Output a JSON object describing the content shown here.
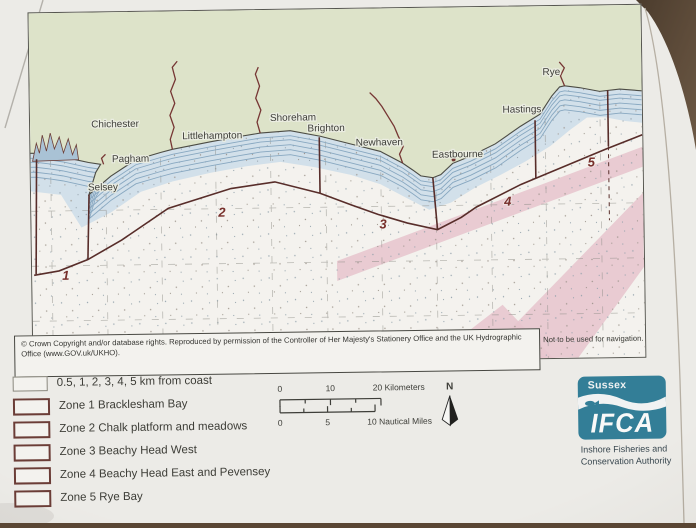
{
  "map": {
    "towns": [
      "Chichester",
      "Pagham",
      "Selsey",
      "Littlehampton",
      "Shoreham",
      "Brighton",
      "Newhaven",
      "Eastbourne",
      "Hastings",
      "Rye"
    ],
    "zone_labels": [
      "1",
      "2",
      "3",
      "4",
      "5"
    ],
    "copyright": "© Crown Copyright and/or database rights. Reproduced by permission of the Controller of Her Majesty's Stationery Office and the UK Hydrographic Office (www.GOV.uk/UKHO).",
    "disclaimer": "Not to be used for navigation.",
    "colors": {
      "land": "#e0e6c9",
      "nearshore": "#d4e3ee",
      "sea": "#f8f6f1",
      "zone_boundary": "#5a2a26",
      "shipping_lane": "#ecc9d2",
      "river": "#7a3330"
    }
  },
  "legend": {
    "items": [
      "0.5, 1, 2, 3, 4, 5 km from coast",
      "Zone 1 Bracklesham Bay",
      "Zone 2 Chalk platform and meadows",
      "Zone 3 Beachy Head West",
      "Zone 4 Beachy Head East and Pevensey",
      "Zone 5 Rye Bay"
    ]
  },
  "scale": {
    "km": {
      "t0": "0",
      "t1": "10",
      "t2": "20 Kilometers"
    },
    "nm": {
      "t0": "0",
      "t1": "5",
      "t2": "10 Nautical Miles"
    },
    "north_label": "N"
  },
  "logo": {
    "region": "Sussex",
    "acronym": "IFCA",
    "subtitle_line1": "Inshore Fisheries and",
    "subtitle_line2": "Conservation Authority",
    "brand_color": "#2b7f9b"
  }
}
